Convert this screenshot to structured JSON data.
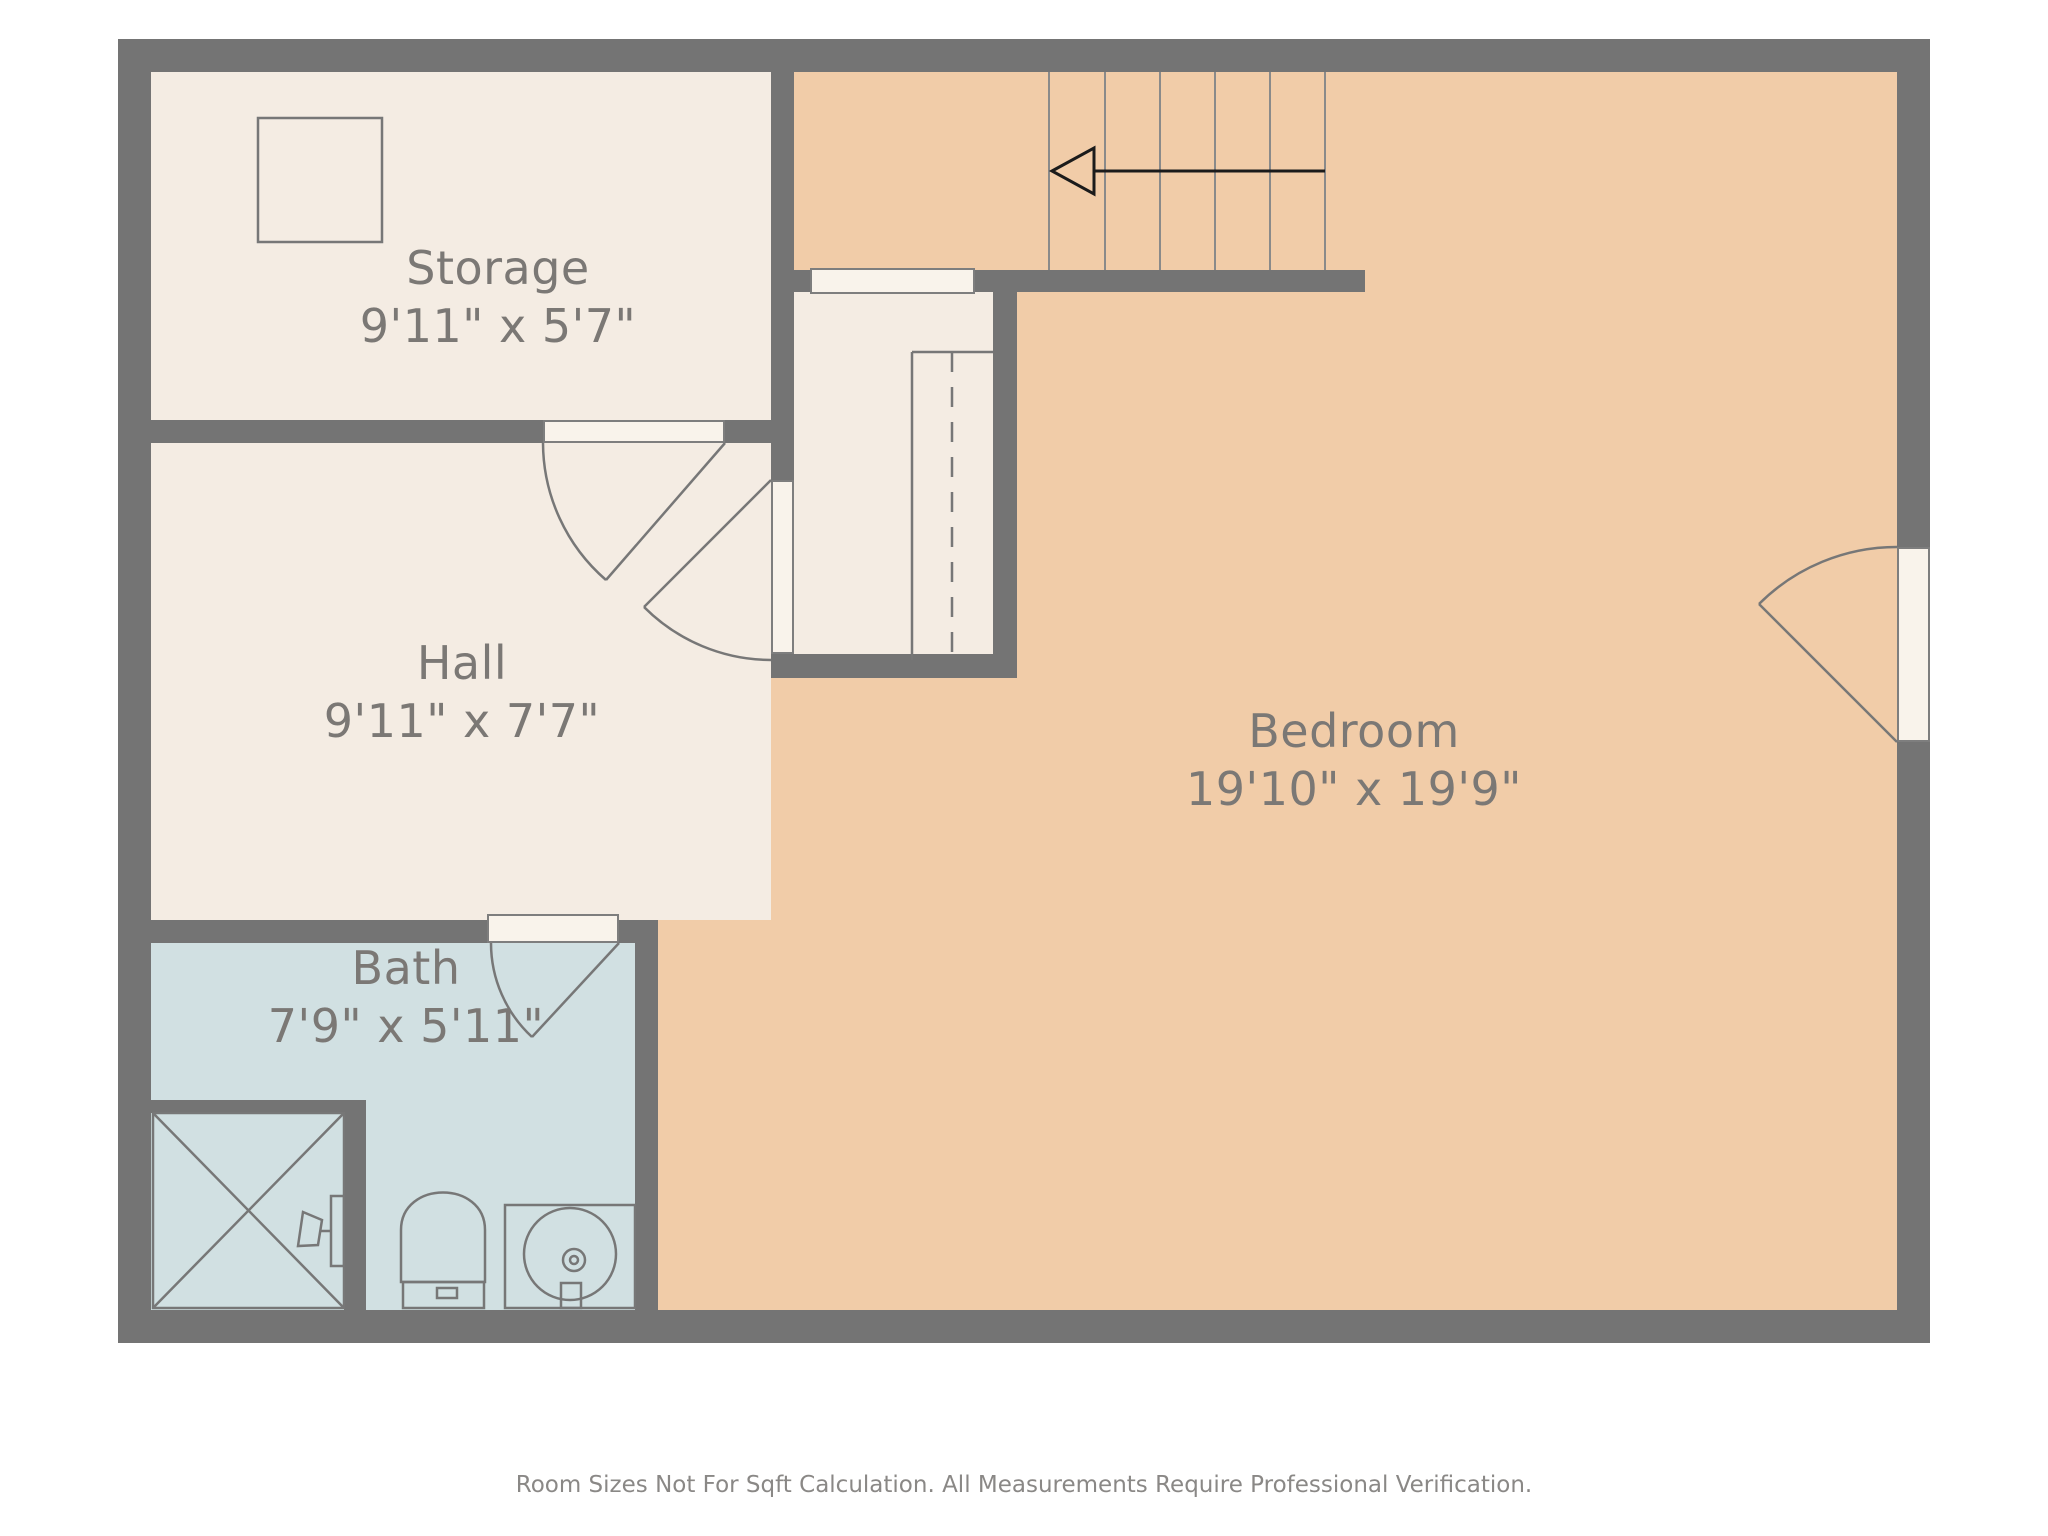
{
  "plan": {
    "rooms": [
      {
        "id": "storage",
        "name": "Storage",
        "dimensions": "9'11\" x 5'7\""
      },
      {
        "id": "hall",
        "name": "Hall",
        "dimensions": "9'11\" x 7'7\""
      },
      {
        "id": "bath",
        "name": "Bath",
        "dimensions": "7'9\" x 5'11\""
      },
      {
        "id": "bedroom",
        "name": "Bedroom",
        "dimensions": "19'10\" x 19'9\""
      }
    ],
    "fixtures": [
      "stairs",
      "closet-rod",
      "shower",
      "toilet",
      "sink-vanity"
    ],
    "stairs_arrow_direction": "left"
  },
  "footer": {
    "disclaimer": "Room Sizes Not For Sqft Calculation. All Measurements Require Professional Verification."
  },
  "colors": {
    "wall": "#747474",
    "bedroom": "#f1cca8",
    "cream": "#f4ece3",
    "bath": "#d1e0e2",
    "opening": "#f9f3eb",
    "line": "#777777",
    "tread": "#8a8a8a",
    "arrow": "#1b1b1b",
    "label": "#7b7875",
    "disclaimer": "#8a8886",
    "bg": "#ffffff"
  }
}
